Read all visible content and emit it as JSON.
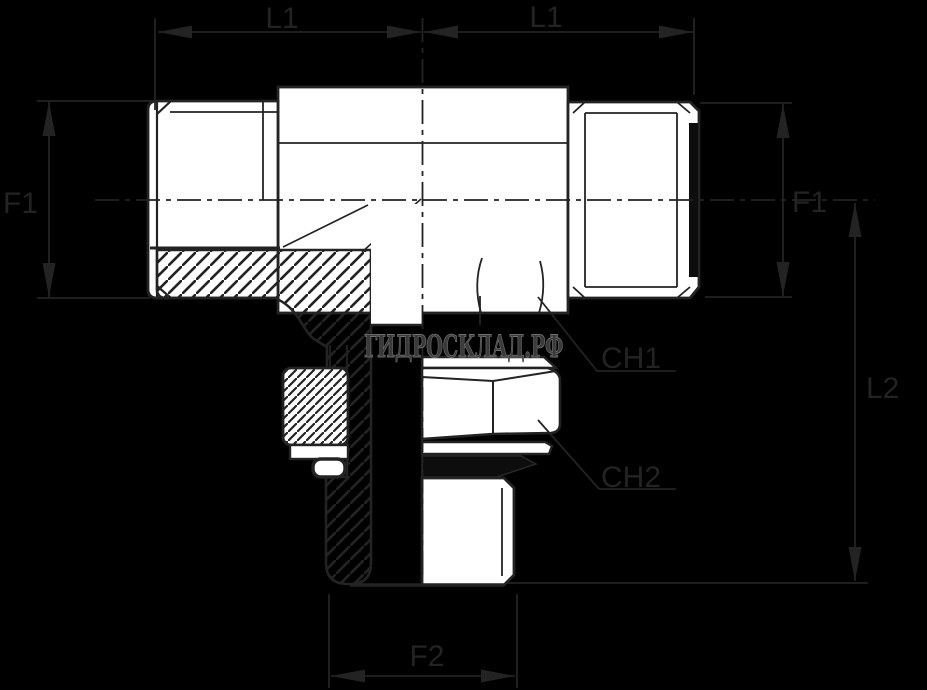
{
  "drawing": {
    "type": "technical-diagram",
    "subject": "hydraulic tee adapter fitting, half-section side view",
    "watermark": "ГИДРОСКЛАД.РФ",
    "labels": {
      "l1_left": "L1",
      "l1_right": "L1",
      "f1_left": "F1",
      "f1_right": "F1",
      "l2": "L2",
      "ch1": "CH1",
      "ch2": "CH2",
      "f2": "F2"
    },
    "colors": {
      "background": "#000000",
      "ink": "#232323",
      "part_fill": "#ffffff",
      "seal_fill": "#0d0d0d",
      "watermark_fill": "#3a3a3a",
      "watermark_stroke": "#6f6f6f"
    }
  }
}
